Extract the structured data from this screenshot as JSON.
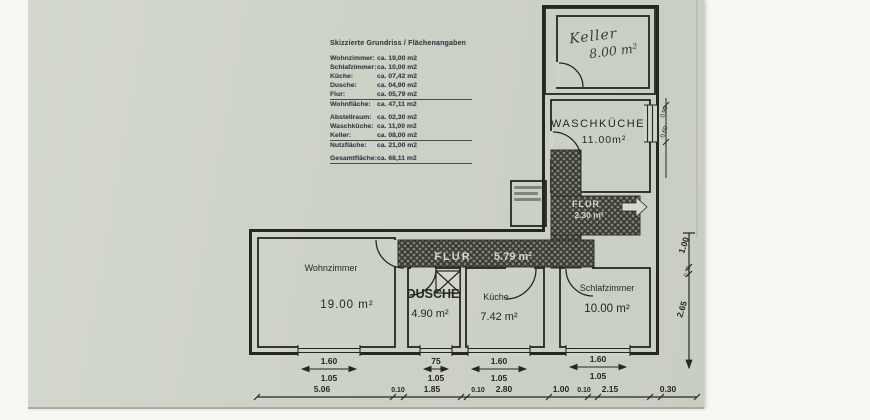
{
  "legend": {
    "title": "Skizzierte Grundriss / Flächenangaben",
    "rows": [
      {
        "label": "Wohnzimmer:",
        "value": "ca. 19,00 m2"
      },
      {
        "label": "Schlafzimmer:",
        "value": "ca. 10,00 m2"
      },
      {
        "label": "Küche:",
        "value": "ca. 07,42 m2"
      },
      {
        "label": "Dusche:",
        "value": "ca. 04,90 m2"
      },
      {
        "label": "Flur:",
        "value": "ca. 05,79 m2"
      },
      {
        "label": "Wohnfläche:",
        "value": "ca. 47,11 m2"
      },
      {
        "label": "Abstellraum:",
        "value": "ca. 02,30 m2"
      },
      {
        "label": "Waschküche:",
        "value": "ca. 11,00 m2"
      },
      {
        "label": "Keller:",
        "value": "ca. 08,00 m2"
      },
      {
        "label": "Nutzfläche:",
        "value": "ca. 21,00 m2"
      },
      {
        "label": "Gesamtfläche:",
        "value": "ca. 68,11 m2"
      }
    ]
  },
  "rooms": {
    "keller": {
      "name": "Keller",
      "area": "8.00 m²"
    },
    "waschkueche": {
      "name": "WASCHKÜCHE",
      "area": "11.00m²"
    },
    "flur_small": {
      "name": "FLUR",
      "area": "2.30 m²"
    },
    "flur_main": {
      "name": "FLUR",
      "area": "5.79 m²"
    },
    "wohnzimmer": {
      "name": "Wohnzimmer",
      "area": "19.00 m²"
    },
    "dusche": {
      "name": "DUSCHE",
      "area": "4.90 m²"
    },
    "kueche": {
      "name": "Küche",
      "area": "7.42 m²"
    },
    "schlafzimmer": {
      "name": "Schlafzimmer",
      "area": "10.00 m²"
    }
  },
  "dims": {
    "windows": [
      {
        "w": "1.60",
        "h": "1.05"
      },
      {
        "w": "75",
        "h": "1.05"
      },
      {
        "w": "1.60",
        "h": "1.05"
      },
      {
        "w": "1.60",
        "h": "1.05"
      }
    ],
    "bottom": [
      "5.06",
      "0.10",
      "1.85",
      "0.10",
      "2.80",
      "1.00",
      "0.10",
      "2.15",
      "0.30"
    ],
    "right": [
      "1.00",
      "0.10",
      "2.65"
    ],
    "wk_window": [
      "0.90",
      "0.60"
    ]
  },
  "colors": {
    "paper": "#ced3c8",
    "ink": "#26271f",
    "hatch": "#4a4b45"
  }
}
